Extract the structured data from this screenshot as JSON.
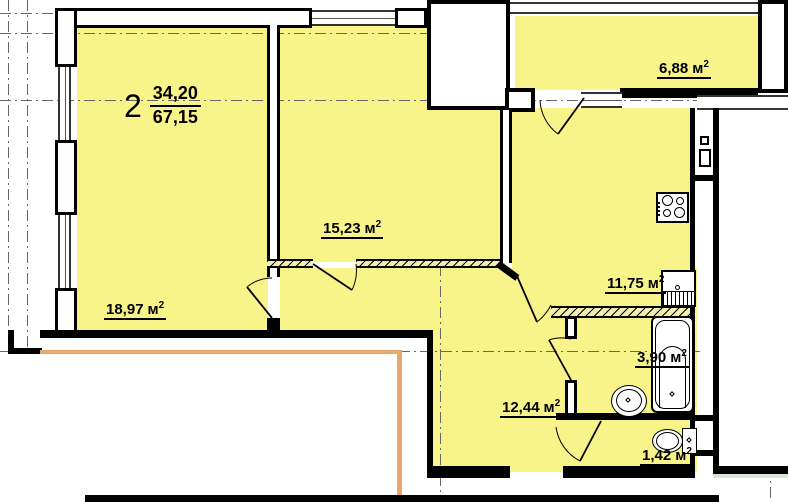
{
  "plan": {
    "title": "apartment-floor-plan",
    "apartment_number": "2",
    "living_area": "34,20",
    "total_area": "67,15",
    "rooms": [
      {
        "id": "living-room",
        "area": "18,97",
        "unit": "м",
        "power": "2"
      },
      {
        "id": "bedroom",
        "area": "15,23",
        "unit": "м",
        "power": "2"
      },
      {
        "id": "balcony",
        "area": "6,88",
        "unit": "м",
        "power": "2"
      },
      {
        "id": "kitchen",
        "area": "11,75",
        "unit": "м",
        "power": "2"
      },
      {
        "id": "bathroom",
        "area": "3,90",
        "unit": "м",
        "power": "2"
      },
      {
        "id": "hallway",
        "area": "12,44",
        "unit": "м",
        "power": "2"
      },
      {
        "id": "wc",
        "area": "1,42",
        "unit": "м",
        "power": "2"
      }
    ],
    "fixtures": [
      "stove-icon",
      "kitchen-sink-icon",
      "bathtub-icon",
      "wash-basin-icon",
      "toilet-icon",
      "vent-shaft-icon"
    ],
    "colors": {
      "room_fill": "#F8F48A",
      "wall": "#000000",
      "accent_line": "#E9A76B",
      "grid_line": "#666666",
      "outside_accent": "#D6E8CF"
    }
  }
}
